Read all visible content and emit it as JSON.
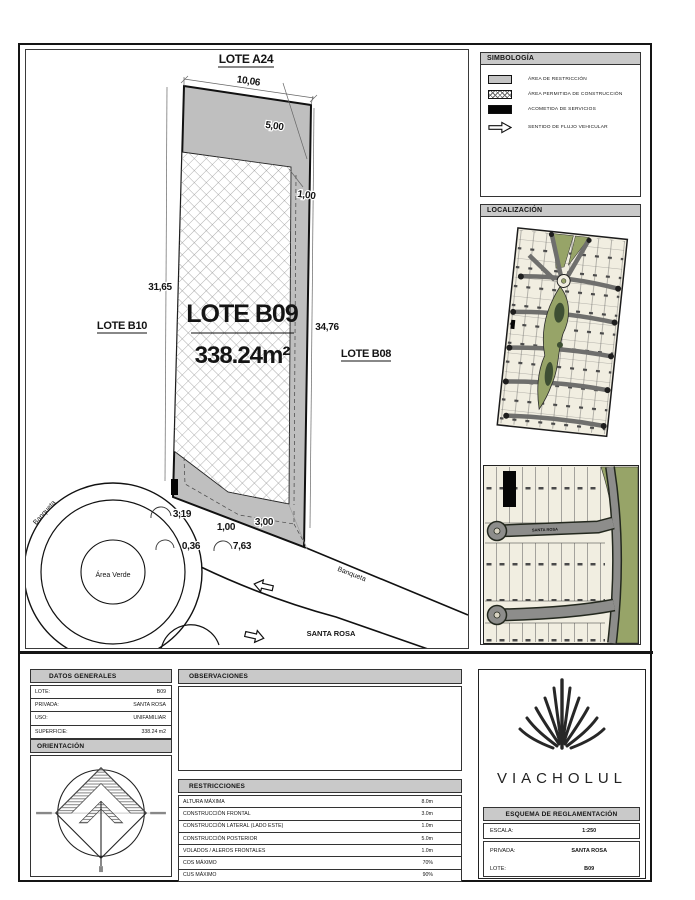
{
  "plan": {
    "adjacent_top": "LOTE A24",
    "adjacent_left": "LOTE B10",
    "adjacent_right": "LOTE B08",
    "lot_name": "LOTE B09",
    "lot_area": "338.24m²",
    "dim_front": "10,06",
    "dim_restriction_depth": "5,00",
    "dim_east_strip": "1,00",
    "dim_west_side": "31,65",
    "dim_east_side": "34,76",
    "dim_b1": "3,19",
    "dim_b2": "1,00",
    "dim_b3": "3,00",
    "dim_b4": "0,36",
    "dim_b5": "7,63",
    "green_area": "Área Verde",
    "sidewalk1": "Banqueta",
    "sidewalk2": "Banqueta",
    "street": "SANTA ROSA"
  },
  "simbologia": {
    "title": "SIMBOLOGÍA",
    "items": [
      {
        "icon": "restriction-area-swatch",
        "label": "ÁREA DE RESTRICCIÓN"
      },
      {
        "icon": "construction-area-swatch",
        "label": "ÁREA PERMITIDA DE CONSTRUCCIÓN"
      },
      {
        "icon": "services-connection-swatch",
        "label": "ACOMETIDA DE SERVICIOS"
      },
      {
        "icon": "vehicle-flow-arrow",
        "label": "SENTIDO DE FLUJO VEHICULAR"
      }
    ]
  },
  "localizacion": {
    "title": "LOCALIZACIÓN",
    "map_street": "SANTA ROSA"
  },
  "datos": {
    "title": "DATOS GENERALES",
    "rows": [
      {
        "label": "LOTE:",
        "value": "B09"
      },
      {
        "label": "PRIVADA:",
        "value": "SANTA ROSA"
      },
      {
        "label": "USO:",
        "value": "UNIFAMILIAR"
      },
      {
        "label": "SUPERFICIE:",
        "value": "338.24 m2"
      }
    ]
  },
  "orientacion": {
    "title": "ORIENTACIÓN"
  },
  "observaciones": {
    "title": "OBSERVACIONES"
  },
  "restricciones": {
    "title": "RESTRICCIONES",
    "rows": [
      {
        "label": "ALTURA MÁXIMA",
        "value": "8.0m"
      },
      {
        "label": "CONSTRUCCIÓN FRONTAL",
        "value": "3.0m"
      },
      {
        "label": "CONSTRUCCIÓN LATERAL (LADO ESTE)",
        "value": "1.0m"
      },
      {
        "label": "CONSTRUCCIÓN POSTERIOR",
        "value": "5.0m"
      },
      {
        "label": "VOLADOS / ALEROS FRONTALES",
        "value": "1.0m"
      },
      {
        "label": "COS MÁXIMO",
        "value": "70%"
      },
      {
        "label": "CUS MÁXIMO",
        "value": "90%"
      }
    ]
  },
  "titleblock": {
    "brand": "VIACHOLUL",
    "title": "ESQUEMA DE REGLAMENTACIÓN",
    "rows": [
      {
        "label": "ESCALA:",
        "value": "1:250"
      },
      {
        "label": "PRIVADA:",
        "value": "SANTA ROSA"
      },
      {
        "label": "LOTE:",
        "value": "B09"
      }
    ]
  },
  "colors": {
    "restriction_gray": "#bfbfbf",
    "header_gray": "#c9c9c9",
    "map_cream": "#f1eee1",
    "road_gray": "#8d8d8b",
    "green": "#97a468",
    "dark_green": "#3e4f33",
    "ink": "#151515"
  }
}
